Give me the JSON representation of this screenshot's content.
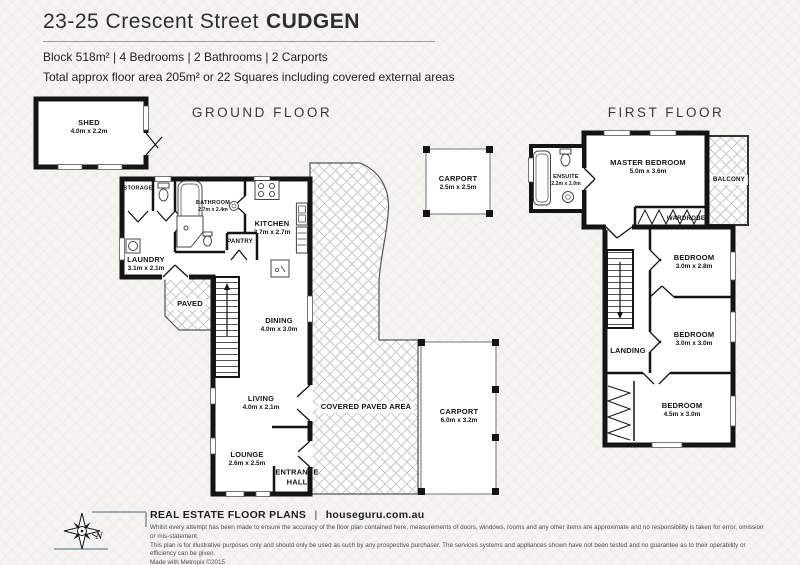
{
  "header": {
    "address": "23-25 Crescent Street",
    "suburb": "CUDGEN",
    "summary": "Block 518m² | 4 Bedrooms | 2 Bathrooms | 2 Carports",
    "area_note": "Total approx floor area 205m² or 22 Squares including covered external areas"
  },
  "ground_floor": {
    "title": "GROUND FLOOR",
    "rooms": {
      "shed": {
        "name": "SHED",
        "dims": "4.0m x 2.2m"
      },
      "storage": {
        "name": "STORAGE"
      },
      "bathroom": {
        "name": "BATHROOM",
        "dims": "2.7m x 2.4m"
      },
      "kitchen": {
        "name": "KITCHEN",
        "dims": "3.7m x 2.7m"
      },
      "pantry": {
        "name": "PANTRY"
      },
      "laundry": {
        "name": "LAUNDRY",
        "dims": "3.1m x 2.1m"
      },
      "paved": {
        "name": "PAVED"
      },
      "dining": {
        "name": "DINING",
        "dims": "4.0m x 3.0m"
      },
      "living": {
        "name": "LIVING",
        "dims": "4.0m x 2.1m"
      },
      "lounge": {
        "name": "LOUNGE",
        "dims": "2.6m x 2.5m"
      },
      "entrance_hall": {
        "name": "ENTRANCE HALL"
      },
      "covered_paved": {
        "name": "COVERED PAVED AREA"
      },
      "carport_front": {
        "name": "CARPORT",
        "dims": "2.5m x 2.5m"
      },
      "carport_side": {
        "name": "CARPORT",
        "dims": "6.0m x 3.2m"
      }
    }
  },
  "first_floor": {
    "title": "FIRST FLOOR",
    "rooms": {
      "master_bedroom": {
        "name": "MASTER BEDROOM",
        "dims": "5.0m x 3.6m"
      },
      "ensuite": {
        "name": "ENSUITE",
        "dims": "2.2m x 2.0m"
      },
      "balcony": {
        "name": "BALCONY"
      },
      "wardrobe": {
        "name": "WARDROBE"
      },
      "bedroom_2": {
        "name": "BEDROOM",
        "dims": "3.0m x 2.8m"
      },
      "bedroom_3": {
        "name": "BEDROOM",
        "dims": "3.0m x 3.0m"
      },
      "landing": {
        "name": "LANDING"
      },
      "bedroom_4": {
        "name": "BEDROOM",
        "dims": "4.5m x 3.0m"
      }
    }
  },
  "footer": {
    "brand": "REAL ESTATE FLOOR PLANS",
    "divider": "|",
    "website": "houseguru.com.au",
    "compass_label": "N",
    "disclaimer_line1": "Whilst every attempt has been made to ensure the accuracy of the floor plan contained here, measurements of doors, windows, rooms and any other items are approximate and no responsibility is taken for error, omission or mis-statement.",
    "disclaimer_line2": "This plan is for illustrative purposes only and should only be used as such by any prospective purchaser. The services systems and appliances shown have not been tested and no guarantee as to their operability or efficiency can be given.",
    "disclaimer_line3": "Made with Metropix ©2015"
  },
  "colors": {
    "wall": "#141414",
    "hatch_line": "#c9c9c9",
    "background": "#f5f4f1",
    "text_dark": "#333333"
  }
}
